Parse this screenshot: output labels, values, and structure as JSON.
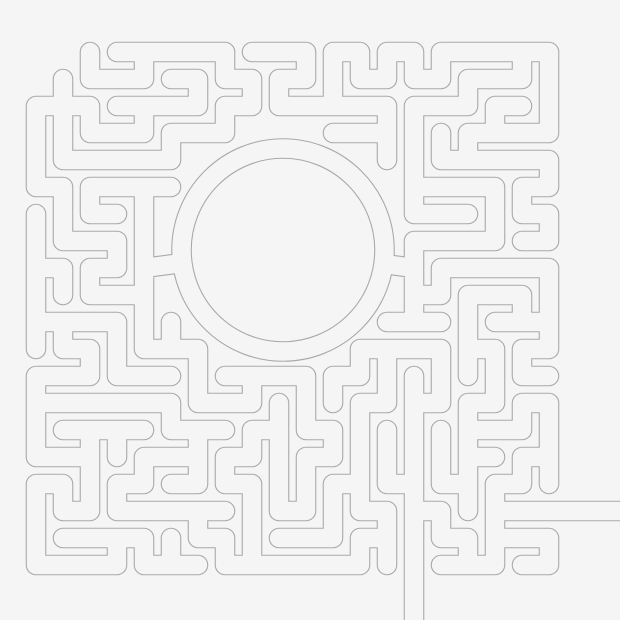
{
  "canvas": {
    "width": 620,
    "height": 620,
    "background_color": "#f5f5f5"
  },
  "maze": {
    "stroke": {
      "line_color": "#a9a9a9",
      "outer_width": 20.6,
      "inner_width": 18.4
    },
    "grid": {
      "cols": 20,
      "rows": 20,
      "x0": 36,
      "y0": 52,
      "step": 27,
      "seed": 1337
    },
    "center_circle": {
      "cx": 283,
      "cy": 250,
      "ring_radius": 101.5,
      "exclusion_radius": 124
    },
    "masked_cells": [
      {
        "i0": 0,
        "j0": 0,
        "i1": 1,
        "j1": 0
      },
      {
        "i0": 0,
        "j0": 1,
        "i1": 0,
        "j1": 1
      },
      {
        "i0": 18,
        "j0": 17,
        "i1": 19,
        "j1": 17
      },
      {
        "i0": 14,
        "j0": 18,
        "i1": 14,
        "j1": 19
      }
    ],
    "ring_connectors": [
      {
        "x1": 144,
        "y1": 268,
        "x2": 182,
        "y2": 263
      },
      {
        "x1": 414,
        "y1": 268,
        "x2": 384,
        "y2": 264
      }
    ],
    "exit_paths": [
      {
        "x1": 495,
        "y1": 511,
        "x2": 626,
        "y2": 511
      },
      {
        "x1": 414,
        "y1": 511,
        "x2": 414,
        "y2": 626
      }
    ]
  }
}
